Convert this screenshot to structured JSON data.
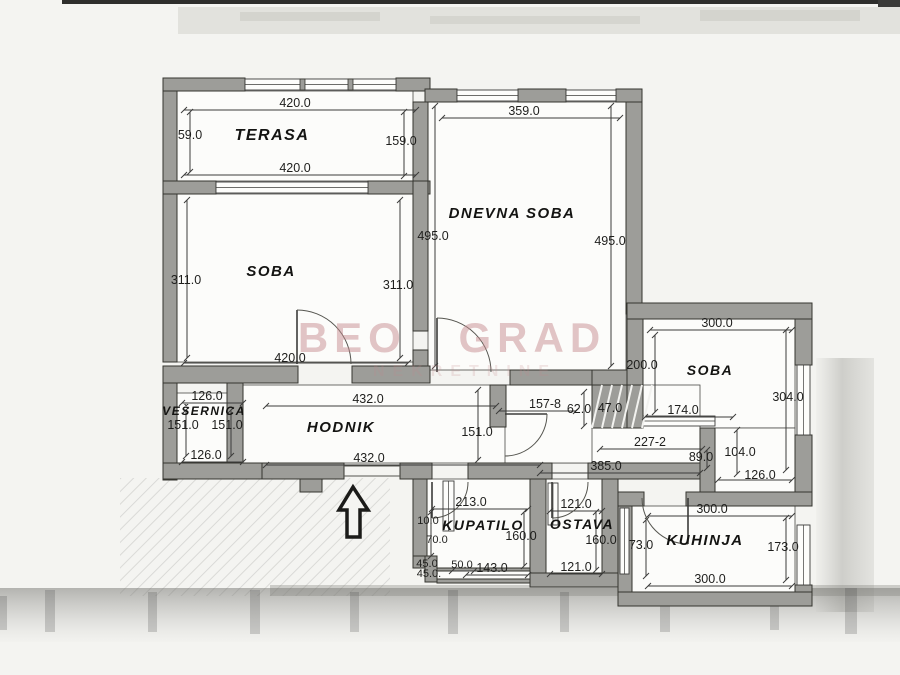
{
  "watermark": {
    "line1": "BEO GRAD",
    "line2": "NEKRETNINE",
    "color": "#c4898c"
  },
  "colors": {
    "wall": "#9d9d99",
    "line": "#3c3c3a",
    "paper": "#f4f4f1",
    "room_fill": "#fcfcfa",
    "ink": "#1f1f1d"
  },
  "rooms": [
    {
      "id": "terasa",
      "name": "TERASA",
      "x": 272,
      "y": 140,
      "size": 16
    },
    {
      "id": "soba-left",
      "name": "SOBA",
      "x": 271,
      "y": 276,
      "size": 15
    },
    {
      "id": "dnevna-soba",
      "name": "DNEVNA SOBA",
      "x": 512,
      "y": 218,
      "size": 15
    },
    {
      "id": "soba-right",
      "name": "SOBA",
      "x": 710,
      "y": 375,
      "size": 14
    },
    {
      "id": "vesernica",
      "name": "VEŠERNICA",
      "x": 204,
      "y": 415,
      "size": 12
    },
    {
      "id": "hodnik",
      "name": "HODNIK",
      "x": 341,
      "y": 432,
      "size": 15
    },
    {
      "id": "kupatilo",
      "name": "KUPATILO",
      "x": 483,
      "y": 530,
      "size": 14
    },
    {
      "id": "ostava",
      "name": "OSTAVA",
      "x": 582,
      "y": 529,
      "size": 14
    },
    {
      "id": "kuhinja",
      "name": "KUHINJA",
      "x": 705,
      "y": 545,
      "size": 15
    }
  ],
  "dimensions": [
    {
      "text": "420.0",
      "x": 295,
      "y": 107
    },
    {
      "text": "59.0",
      "x": 190,
      "y": 139
    },
    {
      "text": "159.0",
      "x": 401,
      "y": 145
    },
    {
      "text": "420.0",
      "x": 295,
      "y": 172
    },
    {
      "text": "359.0",
      "x": 524,
      "y": 115
    },
    {
      "text": "495.0",
      "x": 433,
      "y": 240
    },
    {
      "text": "495.0",
      "x": 610,
      "y": 245
    },
    {
      "text": "311.0",
      "x": 186,
      "y": 284
    },
    {
      "text": "311.0",
      "x": 398,
      "y": 289
    },
    {
      "text": "420.0",
      "x": 290,
      "y": 362
    },
    {
      "text": "300.0",
      "x": 717,
      "y": 327
    },
    {
      "text": "200.0",
      "x": 642,
      "y": 369
    },
    {
      "text": "304.0",
      "x": 788,
      "y": 401
    },
    {
      "text": "174.0",
      "x": 683,
      "y": 414
    },
    {
      "text": "227-2",
      "x": 650,
      "y": 446
    },
    {
      "text": "89.0",
      "x": 701,
      "y": 461
    },
    {
      "text": "104.0",
      "x": 740,
      "y": 456
    },
    {
      "text": "126.0",
      "x": 760,
      "y": 479
    },
    {
      "text": "126.0",
      "x": 207,
      "y": 400
    },
    {
      "text": "151.0",
      "x": 183,
      "y": 429
    },
    {
      "text": "151.0",
      "x": 227,
      "y": 429
    },
    {
      "text": "126.0",
      "x": 206,
      "y": 459
    },
    {
      "text": "432.0",
      "x": 368,
      "y": 403
    },
    {
      "text": "432.0",
      "x": 369,
      "y": 462
    },
    {
      "text": "157-8",
      "x": 545,
      "y": 408
    },
    {
      "text": "62.0",
      "x": 579,
      "y": 413
    },
    {
      "text": "47.0",
      "x": 610,
      "y": 412
    },
    {
      "text": "151.0",
      "x": 477,
      "y": 436
    },
    {
      "text": "385.0",
      "x": 606,
      "y": 470
    },
    {
      "text": "213.0",
      "x": 471,
      "y": 506
    },
    {
      "text": "121.0",
      "x": 576,
      "y": 508
    },
    {
      "text": "300.0",
      "x": 712,
      "y": 513
    },
    {
      "text": "10.0",
      "x": 428,
      "y": 524,
      "size": 11
    },
    {
      "text": "70.0",
      "x": 437,
      "y": 543,
      "size": 11
    },
    {
      "text": "160.0",
      "x": 521,
      "y": 540
    },
    {
      "text": "160.0",
      "x": 601,
      "y": 544
    },
    {
      "text": "73.0",
      "x": 641,
      "y": 549
    },
    {
      "text": "173.0",
      "x": 783,
      "y": 551
    },
    {
      "text": "45.0",
      "x": 427,
      "y": 567,
      "size": 11
    },
    {
      "text": "45.0.",
      "x": 429,
      "y": 577,
      "size": 11
    },
    {
      "text": "50.0",
      "x": 462,
      "y": 568,
      "size": 11
    },
    {
      "text": "143.0",
      "x": 492,
      "y": 572
    },
    {
      "text": "121.0",
      "x": 576,
      "y": 571
    },
    {
      "text": "300.0",
      "x": 710,
      "y": 583
    }
  ]
}
